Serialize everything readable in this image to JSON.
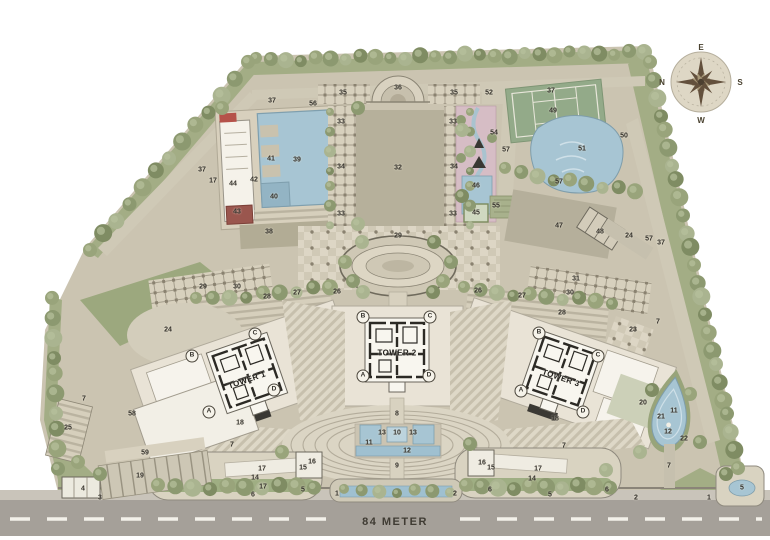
{
  "compass": {
    "top": "E",
    "right": "S",
    "bottom": "W",
    "left": "N"
  },
  "road": {
    "label": "84 METER"
  },
  "towers": [
    {
      "name": "TOWER 1",
      "x": 247,
      "y": 373,
      "rot": -19,
      "label_dy": 7
    },
    {
      "name": "TOWER 2",
      "x": 397,
      "y": 350,
      "rot": 0,
      "label_dy": 3
    },
    {
      "name": "TOWER 3",
      "x": 561,
      "y": 371,
      "rot": 19,
      "label_dy": 7
    }
  ],
  "corner_letters": [
    {
      "t": "B",
      "x": 192,
      "y": 356
    },
    {
      "t": "C",
      "x": 255,
      "y": 334
    },
    {
      "t": "A",
      "x": 209,
      "y": 412
    },
    {
      "t": "D",
      "x": 274,
      "y": 390
    },
    {
      "t": "B",
      "x": 363,
      "y": 317
    },
    {
      "t": "C",
      "x": 430,
      "y": 317
    },
    {
      "t": "A",
      "x": 363,
      "y": 376
    },
    {
      "t": "D",
      "x": 429,
      "y": 376
    },
    {
      "t": "B",
      "x": 539,
      "y": 333
    },
    {
      "t": "C",
      "x": 598,
      "y": 356
    },
    {
      "t": "A",
      "x": 521,
      "y": 391
    },
    {
      "t": "D",
      "x": 583,
      "y": 412
    }
  ],
  "markers": [
    {
      "n": "37",
      "x": 272,
      "y": 101
    },
    {
      "n": "56",
      "x": 313,
      "y": 104
    },
    {
      "n": "37",
      "x": 202,
      "y": 170
    },
    {
      "n": "17",
      "x": 213,
      "y": 181
    },
    {
      "n": "44",
      "x": 233,
      "y": 184
    },
    {
      "n": "41",
      "x": 271,
      "y": 159
    },
    {
      "n": "39",
      "x": 297,
      "y": 160
    },
    {
      "n": "42",
      "x": 254,
      "y": 180
    },
    {
      "n": "40",
      "x": 274,
      "y": 197
    },
    {
      "n": "43",
      "x": 237,
      "y": 212
    },
    {
      "n": "38",
      "x": 269,
      "y": 232
    },
    {
      "n": "35",
      "x": 343,
      "y": 93
    },
    {
      "n": "36",
      "x": 398,
      "y": 88
    },
    {
      "n": "35",
      "x": 454,
      "y": 93
    },
    {
      "n": "52",
      "x": 489,
      "y": 93
    },
    {
      "n": "33",
      "x": 341,
      "y": 122
    },
    {
      "n": "33",
      "x": 453,
      "y": 122
    },
    {
      "n": "34",
      "x": 341,
      "y": 167
    },
    {
      "n": "34",
      "x": 454,
      "y": 167
    },
    {
      "n": "32",
      "x": 398,
      "y": 168
    },
    {
      "n": "33",
      "x": 341,
      "y": 214
    },
    {
      "n": "33",
      "x": 453,
      "y": 214
    },
    {
      "n": "46",
      "x": 476,
      "y": 186
    },
    {
      "n": "55",
      "x": 496,
      "y": 206
    },
    {
      "n": "45",
      "x": 476,
      "y": 213
    },
    {
      "n": "54",
      "x": 494,
      "y": 133
    },
    {
      "n": "57",
      "x": 506,
      "y": 150
    },
    {
      "n": "37",
      "x": 551,
      "y": 91
    },
    {
      "n": "49",
      "x": 553,
      "y": 111
    },
    {
      "n": "51",
      "x": 582,
      "y": 149
    },
    {
      "n": "50",
      "x": 624,
      "y": 136
    },
    {
      "n": "57",
      "x": 559,
      "y": 182
    },
    {
      "n": "47",
      "x": 559,
      "y": 226
    },
    {
      "n": "48",
      "x": 600,
      "y": 232
    },
    {
      "n": "24",
      "x": 629,
      "y": 236
    },
    {
      "n": "57",
      "x": 649,
      "y": 239
    },
    {
      "n": "37",
      "x": 661,
      "y": 243
    },
    {
      "n": "31",
      "x": 576,
      "y": 279
    },
    {
      "n": "23",
      "x": 633,
      "y": 330
    },
    {
      "n": "7",
      "x": 658,
      "y": 322
    },
    {
      "n": "29",
      "x": 203,
      "y": 287
    },
    {
      "n": "30",
      "x": 237,
      "y": 287
    },
    {
      "n": "28",
      "x": 267,
      "y": 297
    },
    {
      "n": "27",
      "x": 297,
      "y": 293
    },
    {
      "n": "26",
      "x": 337,
      "y": 292
    },
    {
      "n": "29",
      "x": 398,
      "y": 236
    },
    {
      "n": "26",
      "x": 478,
      "y": 291
    },
    {
      "n": "27",
      "x": 522,
      "y": 296
    },
    {
      "n": "30",
      "x": 570,
      "y": 293
    },
    {
      "n": "28",
      "x": 562,
      "y": 313
    },
    {
      "n": "24",
      "x": 168,
      "y": 330
    },
    {
      "n": "18",
      "x": 240,
      "y": 423
    },
    {
      "n": "18",
      "x": 555,
      "y": 419
    },
    {
      "n": "8",
      "x": 397,
      "y": 414
    },
    {
      "n": "13",
      "x": 382,
      "y": 433
    },
    {
      "n": "10",
      "x": 397,
      "y": 433
    },
    {
      "n": "13",
      "x": 413,
      "y": 433
    },
    {
      "n": "11",
      "x": 369,
      "y": 443
    },
    {
      "n": "12",
      "x": 407,
      "y": 451
    },
    {
      "n": "9",
      "x": 397,
      "y": 466
    },
    {
      "n": "7",
      "x": 84,
      "y": 399
    },
    {
      "n": "58",
      "x": 132,
      "y": 414
    },
    {
      "n": "25",
      "x": 68,
      "y": 428
    },
    {
      "n": "59",
      "x": 145,
      "y": 453
    },
    {
      "n": "19",
      "x": 140,
      "y": 476
    },
    {
      "n": "4",
      "x": 83,
      "y": 489
    },
    {
      "n": "3",
      "x": 100,
      "y": 498
    },
    {
      "n": "7",
      "x": 232,
      "y": 445
    },
    {
      "n": "17",
      "x": 262,
      "y": 469
    },
    {
      "n": "16",
      "x": 312,
      "y": 462
    },
    {
      "n": "15",
      "x": 303,
      "y": 468
    },
    {
      "n": "14",
      "x": 255,
      "y": 478
    },
    {
      "n": "17",
      "x": 263,
      "y": 487
    },
    {
      "n": "6",
      "x": 253,
      "y": 495
    },
    {
      "n": "5",
      "x": 303,
      "y": 490
    },
    {
      "n": "1",
      "x": 337,
      "y": 494
    },
    {
      "n": "2",
      "x": 455,
      "y": 494
    },
    {
      "n": "16",
      "x": 482,
      "y": 463
    },
    {
      "n": "15",
      "x": 491,
      "y": 468
    },
    {
      "n": "17",
      "x": 538,
      "y": 469
    },
    {
      "n": "14",
      "x": 532,
      "y": 479
    },
    {
      "n": "6",
      "x": 490,
      "y": 490
    },
    {
      "n": "5",
      "x": 550,
      "y": 495
    },
    {
      "n": "6",
      "x": 607,
      "y": 490
    },
    {
      "n": "7",
      "x": 564,
      "y": 446
    },
    {
      "n": "2",
      "x": 636,
      "y": 498
    },
    {
      "n": "1",
      "x": 709,
      "y": 498
    },
    {
      "n": "20",
      "x": 643,
      "y": 403
    },
    {
      "n": "21",
      "x": 661,
      "y": 417
    },
    {
      "n": "11",
      "x": 674,
      "y": 411
    },
    {
      "n": "12",
      "x": 668,
      "y": 432
    },
    {
      "n": "22",
      "x": 684,
      "y": 439
    },
    {
      "n": "7",
      "x": 669,
      "y": 466
    },
    {
      "n": "5",
      "x": 742,
      "y": 488
    }
  ],
  "colors": {
    "site": "#cbc4b1",
    "water": "#a7c5d3",
    "tree": "#99a47b",
    "road": "#a5a099",
    "court": "#93aa89",
    "accent_red": "#9a564e"
  }
}
